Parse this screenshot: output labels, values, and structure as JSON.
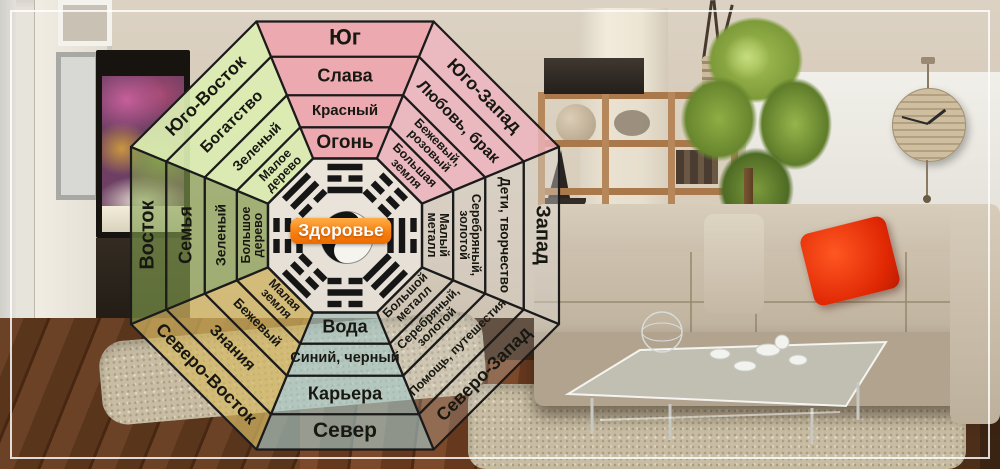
{
  "bagua": {
    "center": {
      "label": "Здоровье",
      "label_bg_color": "#f57c0c",
      "symbol": "yin-yang",
      "fill": "rgba(255,255,255,0.5)",
      "line_color": "#1b1b1b"
    },
    "sectors": [
      {
        "id": "south",
        "direction": "Юг",
        "aspect": "Слава",
        "color": "Красный",
        "element": "Огонь",
        "fill": "rgba(238,166,175,0.95)",
        "trigram": [
          1,
          0,
          1
        ]
      },
      {
        "id": "southwest",
        "direction": "Юго-Запад",
        "aspect": "Любовь, брак",
        "color": "Бежевый,\nрозовый",
        "element": "Большая\nземля",
        "fill": "rgba(240,180,192,0.78)",
        "trigram": [
          0,
          0,
          0
        ]
      },
      {
        "id": "west",
        "direction": "Запад",
        "aspect": "Дети, творчество",
        "color": "Серебряный,\nзолотой",
        "element": "Малый\nметалл",
        "fill": "rgba(224,222,218,0.38)",
        "trigram": [
          1,
          1,
          0
        ]
      },
      {
        "id": "northwest",
        "direction": "Северо-Запад",
        "aspect": "Помощь, путешестия",
        "color": "Серебряный,\nзолотой",
        "element": "Большой\nметалл",
        "fill": "rgba(228,228,228,0.22)",
        "trigram": [
          1,
          1,
          1
        ]
      },
      {
        "id": "north",
        "direction": "Север",
        "aspect": "Карьера",
        "color": "Синий, черный",
        "element": "Вода",
        "fill": "rgba(168,205,206,0.62)",
        "trigram": [
          0,
          1,
          0
        ]
      },
      {
        "id": "northeast",
        "direction": "Северо-Восток",
        "aspect": "Знания",
        "color": "Бежевый",
        "element": "Малая\nземля",
        "fill": "rgba(213,185,100,0.7)",
        "trigram": [
          0,
          0,
          1
        ]
      },
      {
        "id": "east",
        "direction": "Восток",
        "aspect": "Семья",
        "color": "Зеленый",
        "element": "Большое\nдерево",
        "fill": "rgba(133,162,80,0.62)",
        "trigram": [
          1,
          0,
          0
        ]
      },
      {
        "id": "southeast",
        "direction": "Юго-Восток",
        "aspect": "Богатство",
        "color": "Зеленый",
        "element": "Малое\nдерево",
        "fill": "rgba(219,237,178,0.93)",
        "trigram": [
          0,
          1,
          1
        ]
      }
    ]
  },
  "photo": {
    "palette": {
      "wall": "#d4c8b6",
      "white_panel": "#ecebe5",
      "sofa": "#c9bda9",
      "pillow_red": "#e73110",
      "rug": "#c8bda4",
      "wood_floor": "#5d381f",
      "shelf_wood": "#ad7d50",
      "plant_green": "#7d9b39",
      "aquarium_pink": "#c75f9b"
    }
  }
}
